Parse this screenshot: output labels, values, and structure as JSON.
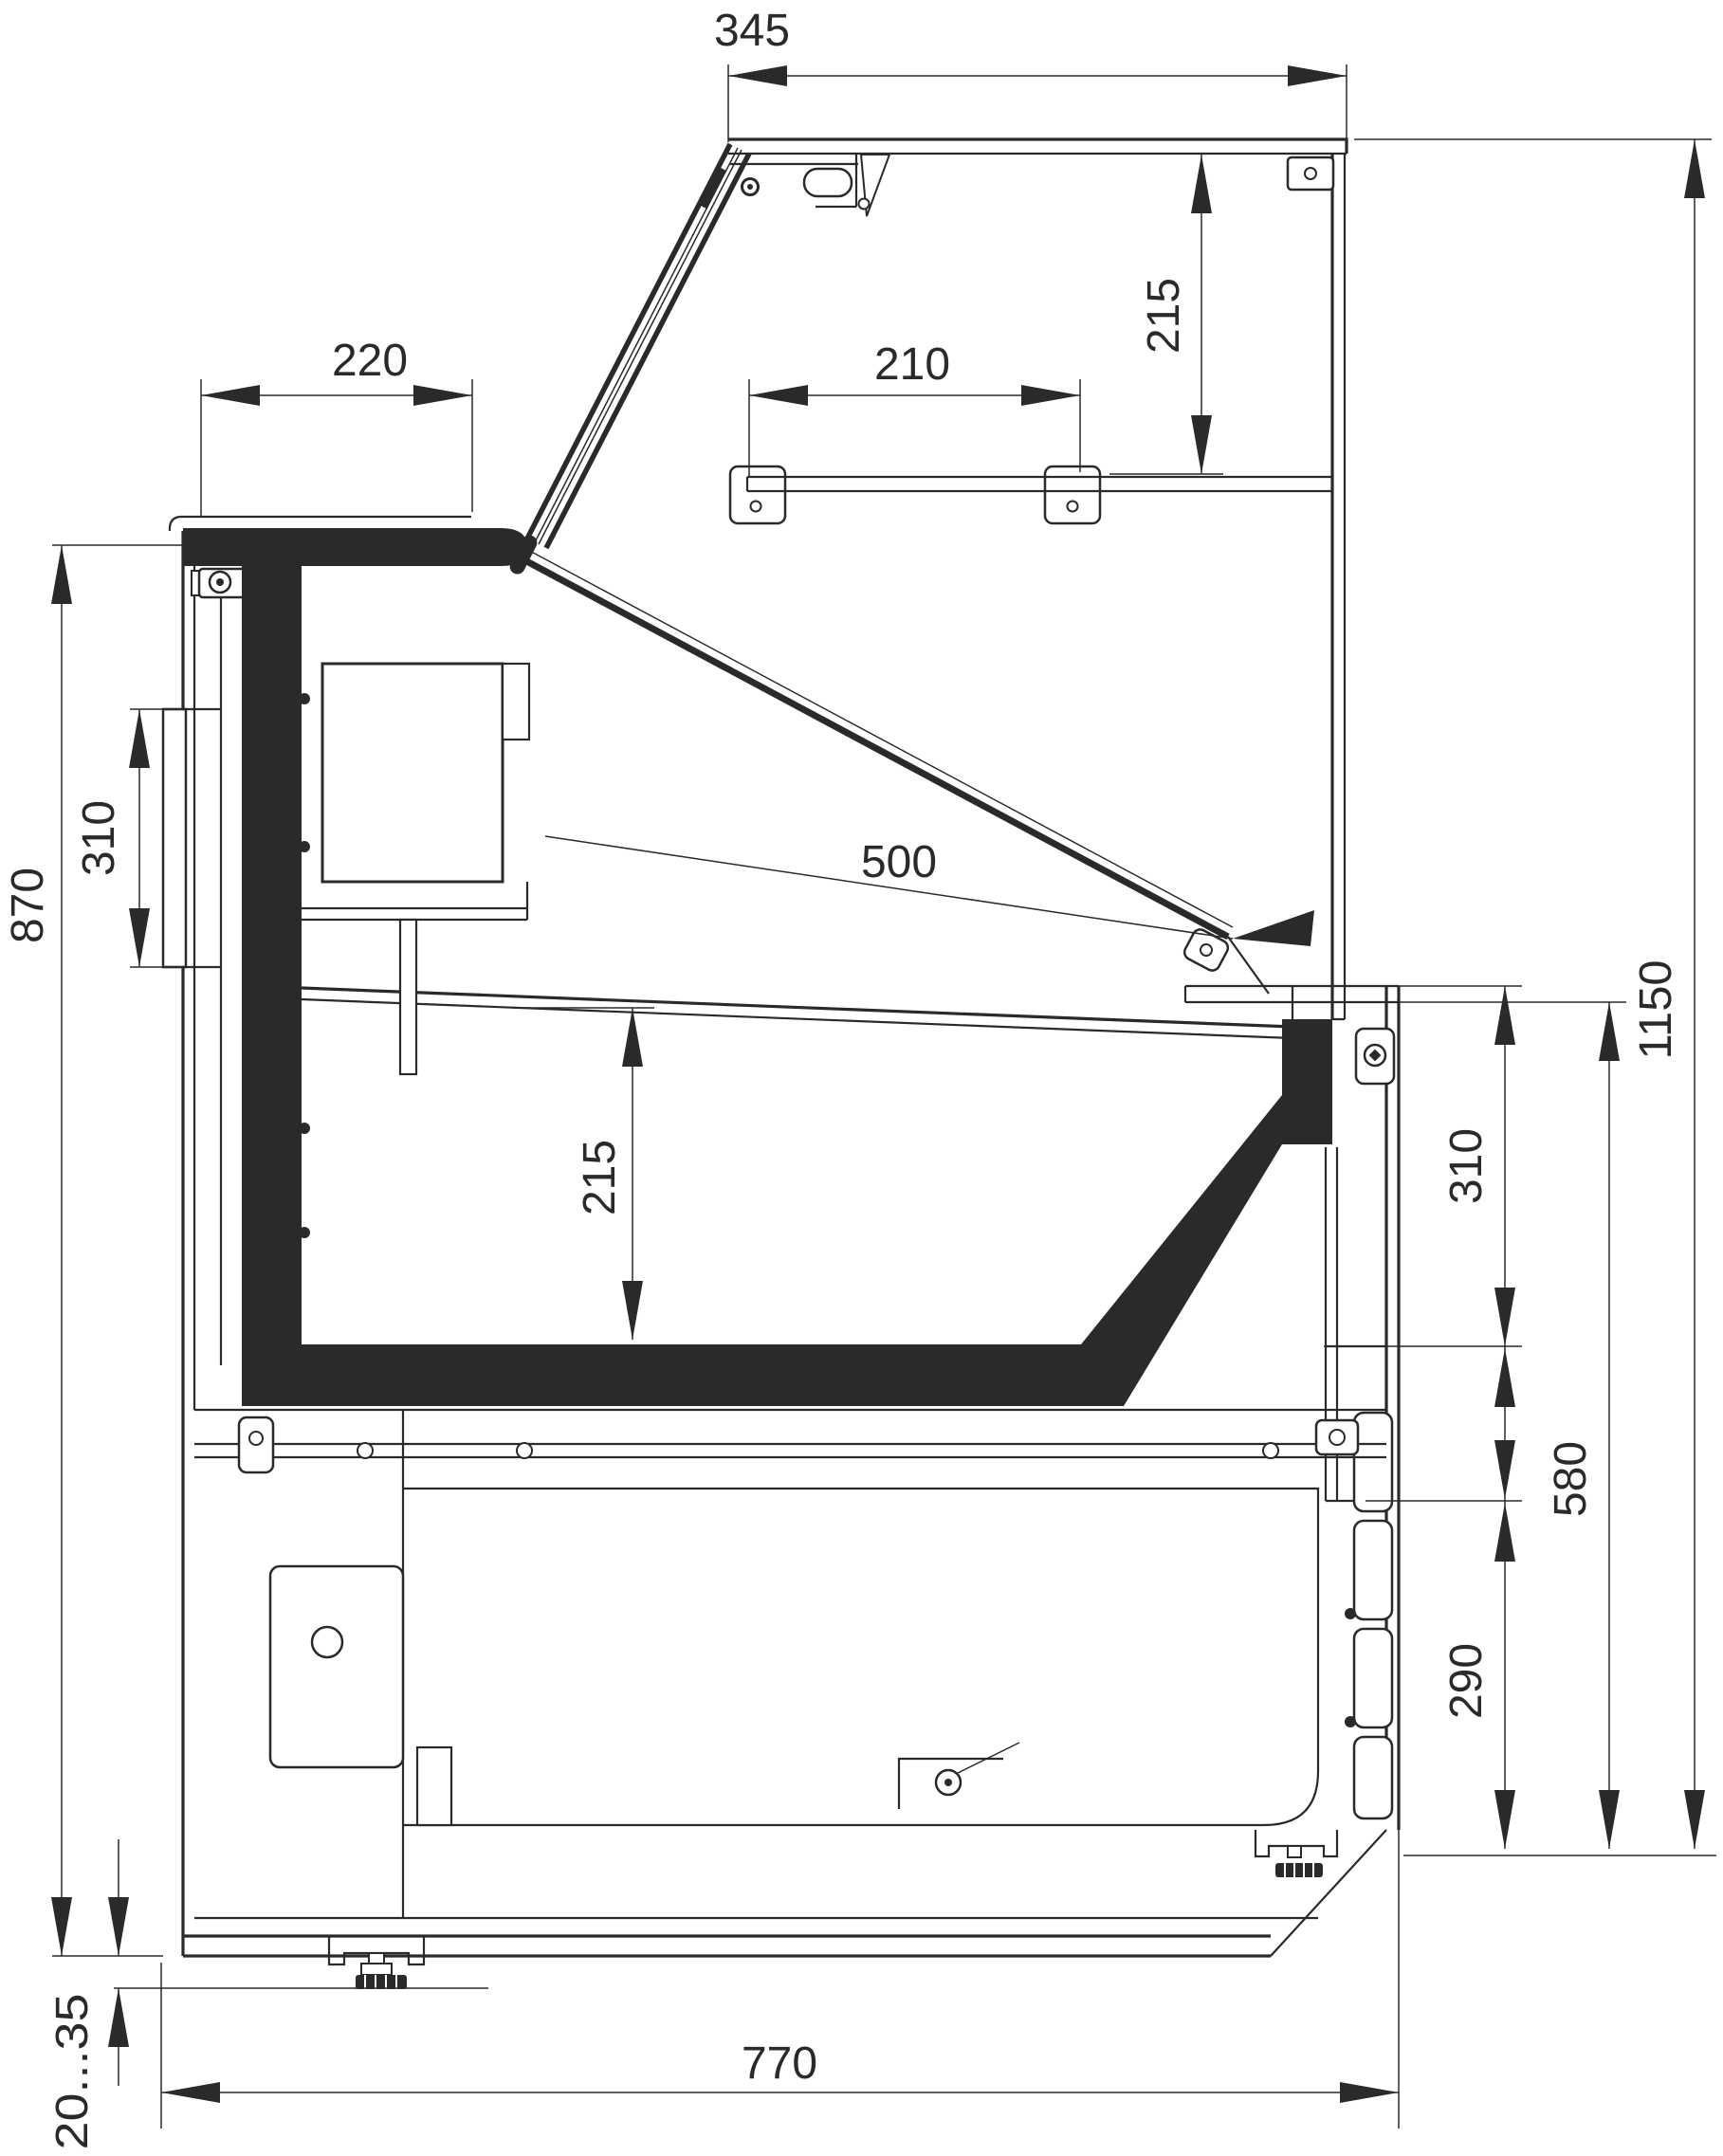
{
  "drawing": {
    "colors": {
      "line": "#2b2a28",
      "background": "#ffffff"
    },
    "dimensions": {
      "canopy_depth": "345",
      "canopy_front_height": "215",
      "countertop_depth": "220",
      "shelf_length": "210",
      "glass_length": "500",
      "side_panel_height": "310",
      "worktop_height": "870",
      "well_depth": "215",
      "overall_height": "1150",
      "front_upper_panel_height": "310",
      "front_lower_height": "580",
      "louver_panel_height": "290",
      "base_depth": "770",
      "foot_adjustment_range": "20...35"
    }
  }
}
